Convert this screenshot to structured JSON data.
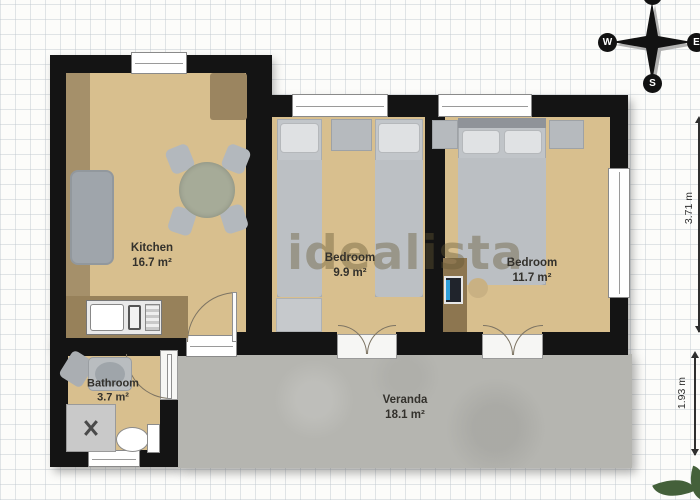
{
  "watermark": "idealista",
  "compass": {
    "n": "N",
    "w": "W",
    "e": "E",
    "s": "S"
  },
  "rooms": {
    "kitchen": {
      "name": "Kitchen",
      "area": "16.7 m²"
    },
    "bedroom1": {
      "name": "Bedroom",
      "area": "9.9 m²"
    },
    "bedroom2": {
      "name": "Bedroom",
      "area": "11.7 m²"
    },
    "bathroom": {
      "name": "Bathroom",
      "area": "3.7 m²"
    },
    "veranda": {
      "name": "Veranda",
      "area": "18.1 m²"
    }
  },
  "dimensions": {
    "right": "3.71 m",
    "veranda": "1.93 m"
  },
  "colors": {
    "wall": "#141414",
    "floor": "#d8bf8e",
    "veranda_concrete": "#b5b5b0",
    "furniture_gray": "#c2c6ca",
    "counter_brown": "#a08a60",
    "watermark": "rgba(100,88,50,0.40)",
    "plant_green": "#44603a"
  }
}
